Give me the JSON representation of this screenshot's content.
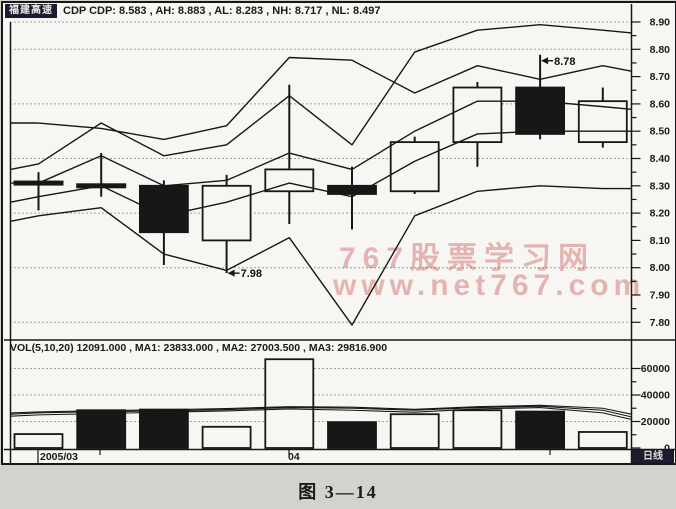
{
  "window": {
    "stock_name": "福建高速",
    "indicator_line": "CDP  CDP: 8.583 , AH: 8.883 , AL: 8.283 , NH: 8.717 , NL: 8.497",
    "volume_line": "VOL(5,10,20)  12091.000 , MA1: 23833.000 , MA2: 27003.500 , MA3: 29816.900",
    "period_label": "日线",
    "date_labels": [
      {
        "text": "2005/03"
      },
      {
        "text": "04"
      }
    ]
  },
  "watermark": {
    "line1": "767股票学习网",
    "line2": "www.net767.com",
    "color": "#d98c8c"
  },
  "caption": "图 3—14",
  "colors": {
    "ink": "#171717",
    "chart_bg": "#f7f6f2",
    "page_bg": "#d3d2ce",
    "highlight_box": "#1c1c2e"
  },
  "chart_data": {
    "type": "candlestick+volume",
    "title": "CDP indicator daily chart",
    "price_axis": {
      "tick_labels": [
        "8.90",
        "8.80",
        "8.70",
        "8.60",
        "8.50",
        "8.40",
        "8.30",
        "8.20",
        "8.10",
        "8.00",
        "7.90",
        "7.80"
      ],
      "grid": [
        8.9,
        8.8,
        8.6,
        8.4,
        8.2,
        8.0,
        7.8
      ],
      "range": [
        7.76,
        8.92
      ]
    },
    "vol_axis": {
      "tick_labels": [
        "60000",
        "40000",
        "20000",
        "0"
      ],
      "grid": [
        60000,
        40000,
        20000
      ],
      "range": [
        0,
        68000
      ]
    },
    "candles": [
      {
        "open": 8.31,
        "high": 8.35,
        "low": 8.21,
        "close": 8.31,
        "color": "black",
        "doji": true
      },
      {
        "open": 8.3,
        "high": 8.42,
        "low": 8.26,
        "close": 8.3,
        "color": "black",
        "doji": true
      },
      {
        "open": 8.3,
        "high": 8.32,
        "low": 8.01,
        "close": 8.13,
        "color": "black",
        "doji": false
      },
      {
        "open": 8.1,
        "high": 8.34,
        "low": 7.98,
        "close": 8.3,
        "color": "white",
        "doji": false
      },
      {
        "open": 8.28,
        "high": 8.67,
        "low": 8.16,
        "close": 8.36,
        "color": "white",
        "doji": false
      },
      {
        "open": 8.3,
        "high": 8.37,
        "low": 8.14,
        "close": 8.27,
        "color": "black",
        "doji": false
      },
      {
        "open": 8.28,
        "high": 8.48,
        "low": 8.27,
        "close": 8.46,
        "color": "white",
        "doji": false
      },
      {
        "open": 8.46,
        "high": 8.68,
        "low": 8.37,
        "close": 8.66,
        "color": "white",
        "doji": false
      },
      {
        "open": 8.66,
        "high": 8.78,
        "low": 8.47,
        "close": 8.49,
        "color": "black",
        "doji": false
      },
      {
        "open": 8.46,
        "high": 8.66,
        "low": 8.44,
        "close": 8.61,
        "color": "white",
        "doji": false
      }
    ],
    "volumes": [
      {
        "value": 10500,
        "color": "white"
      },
      {
        "value": 28500,
        "color": "black"
      },
      {
        "value": 29000,
        "color": "black"
      },
      {
        "value": 16000,
        "color": "white"
      },
      {
        "value": 67000,
        "color": "white"
      },
      {
        "value": 19500,
        "color": "black"
      },
      {
        "value": 25500,
        "color": "white"
      },
      {
        "value": 28500,
        "color": "white"
      },
      {
        "value": 27500,
        "color": "black"
      },
      {
        "value": 12091,
        "color": "white"
      }
    ],
    "cdp_lines": [
      {
        "name": "AH",
        "prices": [
          8.36,
          8.38,
          8.53,
          8.41,
          8.45,
          8.63,
          8.45,
          8.79,
          8.87,
          8.89,
          8.87,
          8.86
        ]
      },
      {
        "name": "NH",
        "prices": [
          8.53,
          8.53,
          8.51,
          8.47,
          8.52,
          8.77,
          8.76,
          8.64,
          8.74,
          8.69,
          8.74,
          8.72
        ]
      },
      {
        "name": "CDP",
        "prices": [
          8.31,
          8.31,
          8.41,
          8.3,
          8.32,
          8.42,
          8.36,
          8.5,
          8.61,
          8.61,
          8.59,
          8.58
        ]
      },
      {
        "name": "NL",
        "prices": [
          8.24,
          8.26,
          8.3,
          8.19,
          8.24,
          8.31,
          8.26,
          8.39,
          8.49,
          8.5,
          8.5,
          8.5
        ]
      },
      {
        "name": "AL",
        "prices": [
          8.17,
          8.19,
          8.22,
          8.05,
          7.99,
          8.11,
          7.79,
          8.19,
          8.28,
          8.3,
          8.29,
          8.29
        ]
      }
    ],
    "vol_ma": [
      {
        "name": "MA1",
        "values": [
          25500,
          26500,
          27500,
          28000,
          29000,
          30500,
          30000,
          28500,
          30500,
          31500,
          28500,
          23500
        ]
      },
      {
        "name": "MA2",
        "values": [
          24000,
          25000,
          26000,
          27000,
          28000,
          29500,
          28500,
          27000,
          29500,
          30500,
          26500,
          21500
        ]
      },
      {
        "name": "MA3",
        "values": [
          26500,
          27200,
          28200,
          28800,
          29800,
          31200,
          30800,
          29200,
          31200,
          32200,
          30000,
          25500
        ]
      }
    ],
    "annotations": [
      {
        "label": "8.78",
        "day": 8,
        "price": 8.78
      },
      {
        "label": "7.98",
        "day": 3,
        "price": 7.98
      }
    ]
  }
}
